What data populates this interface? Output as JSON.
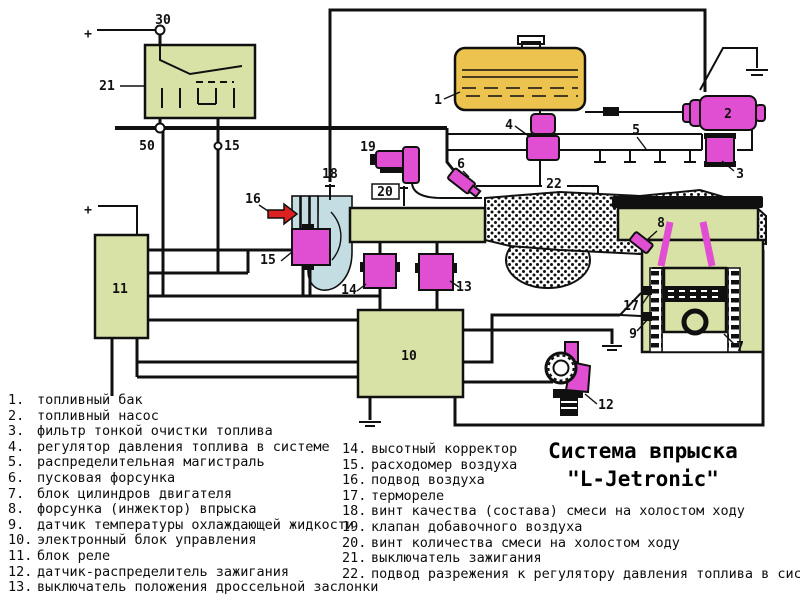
{
  "title": {
    "line1": "Система впрыска",
    "line2": "\"L-Jetronic\""
  },
  "legend_left": [
    {
      "n": "1.",
      "text": "топливный бак"
    },
    {
      "n": "2.",
      "text": "топливный насос"
    },
    {
      "n": "3.",
      "text": "фильтр тонкой очистки топлива"
    },
    {
      "n": "4.",
      "text": "регулятор давления топлива в системе"
    },
    {
      "n": "5.",
      "text": "распределительная магистраль"
    },
    {
      "n": "6.",
      "text": "пусковая форсунка"
    },
    {
      "n": "7.",
      "text": "блок цилиндров двигателя"
    },
    {
      "n": "8.",
      "text": "форсунка (инжектор) впрыска"
    },
    {
      "n": "9.",
      "text": "датчик температуры охлаждающей жидкости"
    },
    {
      "n": "10.",
      "text": "электронный блок управления"
    },
    {
      "n": "11.",
      "text": "блок реле"
    },
    {
      "n": "12.",
      "text": "датчик-распределитель зажигания"
    },
    {
      "n": "13.",
      "text": "выключатель положения дроссельной заслонки"
    }
  ],
  "legend_right": [
    {
      "n": "14.",
      "text": "высотный корректор"
    },
    {
      "n": "15.",
      "text": "расходомер воздуха"
    },
    {
      "n": "16.",
      "text": "подвод воздуха"
    },
    {
      "n": "17.",
      "text": "термореле"
    },
    {
      "n": "18.",
      "text": "винт качества (состава) смеси на холостом ходу"
    },
    {
      "n": "19.",
      "text": "клапан добавочного воздуха"
    },
    {
      "n": "20.",
      "text": "винт количества смеси на холостом ходу"
    },
    {
      "n": "21.",
      "text": "выключатель зажигания"
    },
    {
      "n": "22.",
      "text": "подвод разрежения к регулятору давления топлива в системе"
    }
  ],
  "diagram_labels": [
    {
      "text": "+",
      "x": 88,
      "y": 38,
      "size": 22
    },
    {
      "text": "30",
      "x": 163,
      "y": 24,
      "size": 14
    },
    {
      "text": "50",
      "x": 147,
      "y": 150,
      "size": 14
    },
    {
      "text": "15",
      "x": 232,
      "y": 150,
      "size": 14
    },
    {
      "text": "21",
      "x": 107,
      "y": 90
    },
    {
      "text": "+",
      "x": 88,
      "y": 214,
      "size": 22
    },
    {
      "text": "1",
      "x": 438,
      "y": 104
    },
    {
      "text": "2",
      "x": 728,
      "y": 118
    },
    {
      "text": "3",
      "x": 740,
      "y": 178
    },
    {
      "text": "4",
      "x": 509,
      "y": 129
    },
    {
      "text": "5",
      "x": 636,
      "y": 134
    },
    {
      "text": "6",
      "x": 461,
      "y": 168
    },
    {
      "text": "7",
      "x": 740,
      "y": 351
    },
    {
      "text": "8",
      "x": 661,
      "y": 227
    },
    {
      "text": "9",
      "x": 633,
      "y": 338
    },
    {
      "text": "10",
      "x": 409,
      "y": 360,
      "size": 14
    },
    {
      "text": "11",
      "x": 120,
      "y": 293,
      "size": 14
    },
    {
      "text": "12",
      "x": 606,
      "y": 409
    },
    {
      "text": "13",
      "x": 464,
      "y": 291
    },
    {
      "text": "14",
      "x": 349,
      "y": 294
    },
    {
      "text": "15",
      "x": 268,
      "y": 264
    },
    {
      "text": "16",
      "x": 253,
      "y": 203
    },
    {
      "text": "17",
      "x": 631,
      "y": 310
    },
    {
      "text": "18",
      "x": 330,
      "y": 178
    },
    {
      "text": "19",
      "x": 368,
      "y": 151
    },
    {
      "text": "20",
      "x": 385,
      "y": 196
    },
    {
      "text": "22",
      "x": 554,
      "y": 188
    }
  ],
  "colors": {
    "green": "#d8e2a6",
    "magenta": "#e04fd1",
    "yellow": "#ecc34e",
    "blue": "#c3dde2",
    "red": "#dd2020"
  }
}
